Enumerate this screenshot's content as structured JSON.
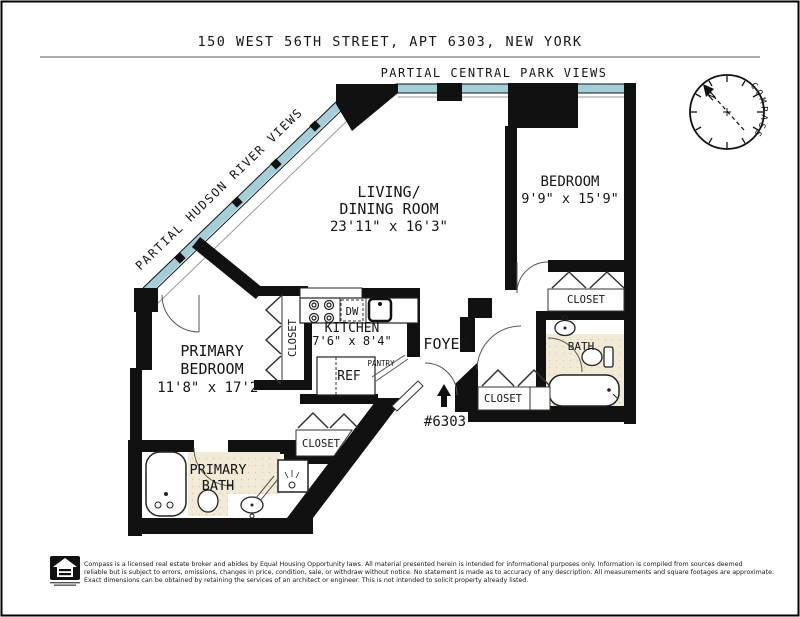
{
  "header": {
    "title": "150 WEST 56TH STREET, APT 6303, NEW YORK"
  },
  "views": {
    "central_park": "PARTIAL CENTRAL PARK VIEWS",
    "hudson_river": "PARTIAL HUDSON RIVER VIEWS"
  },
  "compass": {
    "label": "COMPASS",
    "north": "N"
  },
  "rooms": {
    "living_dining": {
      "line1": "LIVING/",
      "line2": "DINING ROOM",
      "dims": "23'11\" x 16'3\""
    },
    "bedroom": {
      "name": "BEDROOM",
      "dims": "9'9\" x 15'9\""
    },
    "primary_bedroom": {
      "line1": "PRIMARY",
      "line2": "BEDROOM",
      "dims": "11'8\" x 17'2\""
    },
    "kitchen": {
      "name": "KITCHEN",
      "dims": "7'6\" x 8'4\"",
      "dw": "DW",
      "ref": "REF",
      "pantry": "PANTRY"
    },
    "foyer": {
      "name": "FOYER",
      "unit_number": "#6303"
    },
    "bath": {
      "name": "BATH"
    },
    "primary_bath": {
      "line1": "PRIMARY",
      "line2": "BATH"
    },
    "closet": "CLOSET"
  },
  "footer": {
    "line1": "Compass is a licensed real estate broker and abides by Equal Housing Opportunity laws. All material presented herein is intended for informational purposes only. Information is compiled from sources deemed",
    "line2": "reliable but is subject to errors, omissions, changes in price, condition, sale, or withdraw without notice. No statement is made as to accuracy of any description. All measurements and square footages are approximate.",
    "line3": "Exact dimensions can be obtained by retaining the services of an architect or engineer. This is not intended to solicit property already listed."
  },
  "colors": {
    "window": "#a5cfd8",
    "wall": "#111111",
    "tile": "#f1ead6",
    "tile_dot": "#d9cfae",
    "north": "#cc2a1e"
  }
}
